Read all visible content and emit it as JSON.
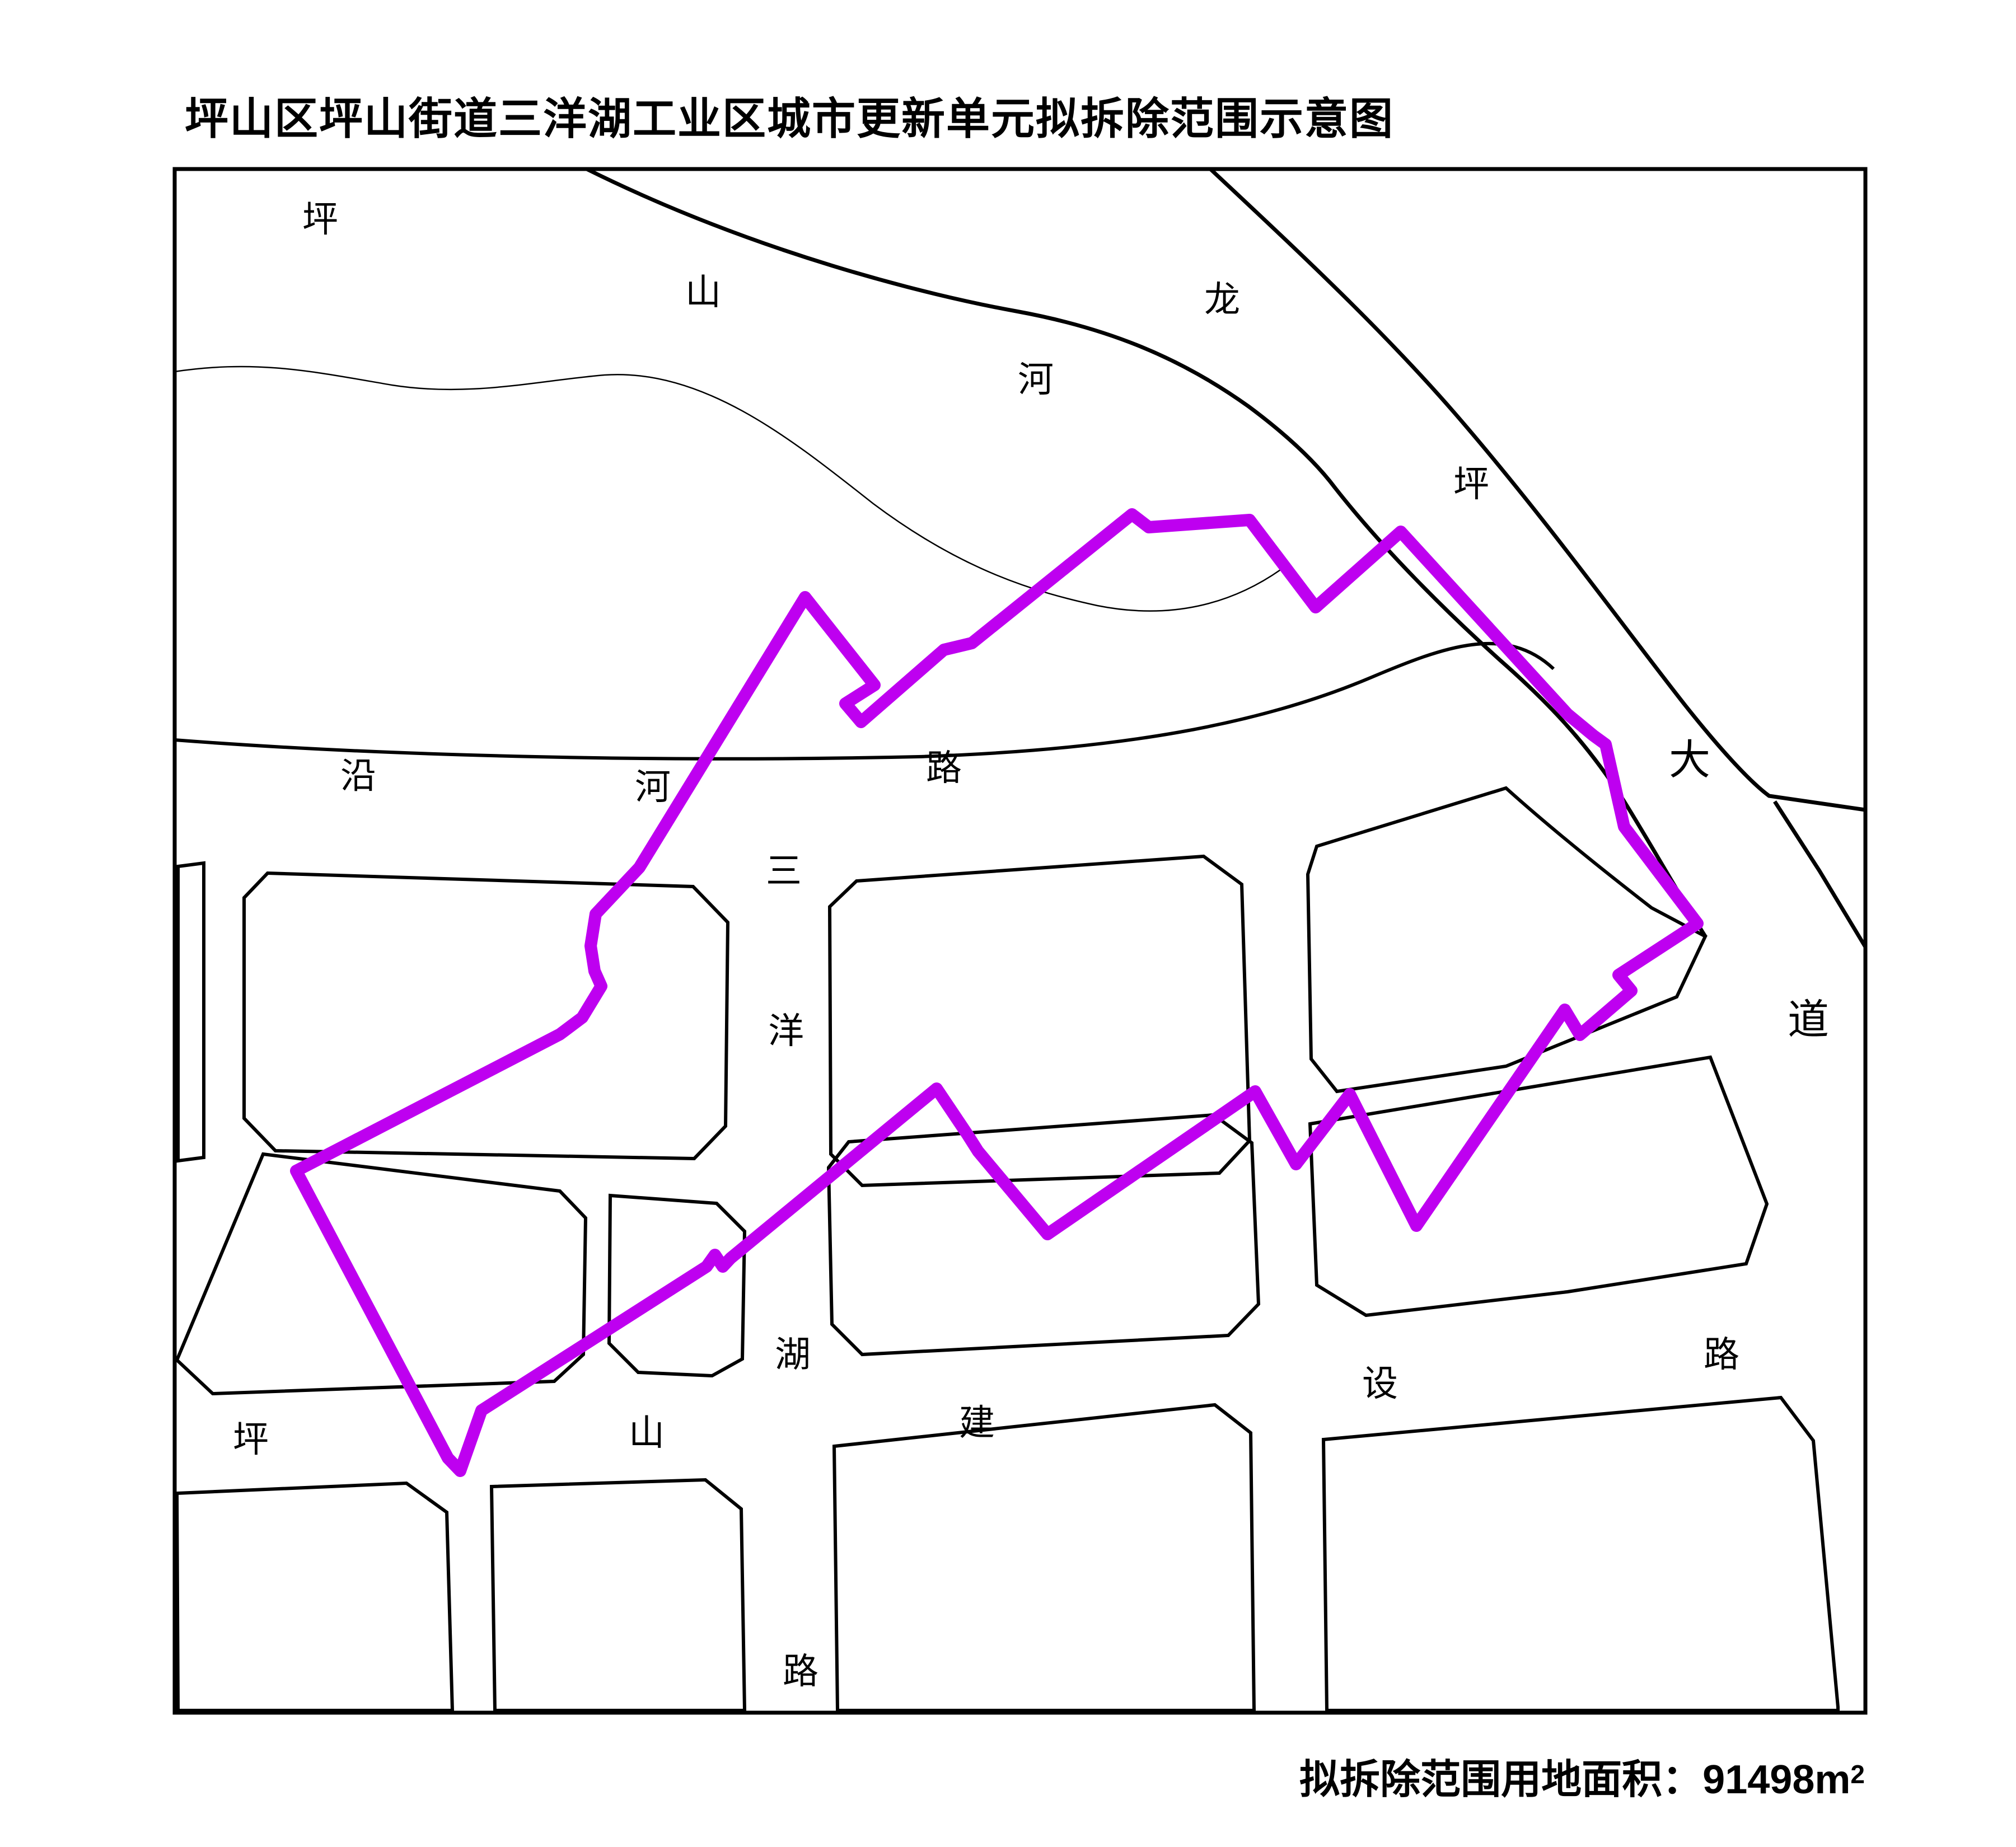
{
  "title": "坪山区坪山街道三洋湖工业区城市更新单元拟拆除范围示意图",
  "area_note": {
    "label": "拟拆除范围用地面积：",
    "value": "91498",
    "unit_m": "m",
    "unit_exp": "2"
  },
  "map": {
    "colors": {
      "boundary": "#BE00F0",
      "line": "#000000",
      "background": "#FFFFFF"
    },
    "river_label": [
      "坪",
      "山",
      "河"
    ],
    "avenue_label": [
      "龙",
      "坪",
      "大",
      "道"
    ],
    "yanhe_road_label": [
      "沿",
      "河",
      "路"
    ],
    "sanyanghu_road_label": [
      "三",
      "洋",
      "湖",
      "路"
    ],
    "south_road_label": [
      "坪",
      "山",
      "建",
      "设",
      "路"
    ]
  }
}
